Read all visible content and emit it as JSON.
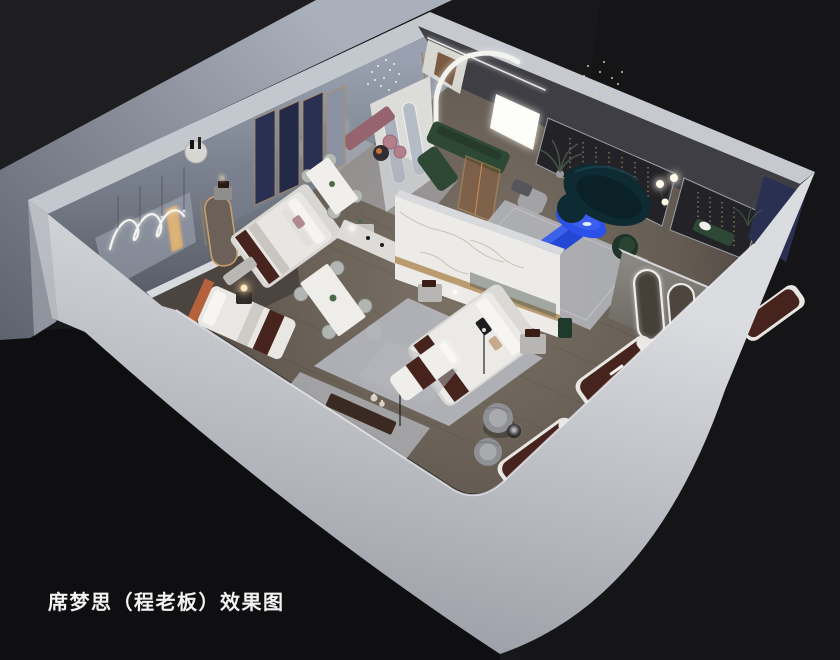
{
  "image": {
    "kind": "3d-isometric-interior-render",
    "subject": "mattress showroom cutaway floor-plan rendering",
    "caption": "席梦思（程老板）效果图"
  },
  "caption": {
    "text": "席梦思（程老板）效果图"
  },
  "palette": {
    "background": "#18181a",
    "background_deep": "#0f0f12",
    "outside_ground_light": "#a8adb8",
    "outside_ground_dark": "#5f6470",
    "wall_top": "#c5c9cf",
    "wall_inner_top": "#98a0af",
    "wall_inner_bottom": "#555a65",
    "floor_light": "#7d7367",
    "floor_dark": "#463f3a",
    "marble": "#edebe7",
    "gold": "#b08d5a",
    "accent_blue": "#2b51e8",
    "console_blue": "#2448d6",
    "sofa_teal": "#0e2b33",
    "sofa_green": "#2e4836",
    "armchair_green": "#1f3328",
    "mattress_brown": "#46231c",
    "headboard_terracotta": "#b5613c",
    "navy_panel": "#2a3052",
    "bench_mauve": "#96646e",
    "pouf_pink": "#b27f8a",
    "rug": "#b6b8bf",
    "neon_white": "#f4f4ef",
    "fairy_gold": "#d2b57f",
    "caption_text": "#f2f2f2"
  },
  "elements": [
    "neon-squiggle-wall-light",
    "pendant-crystal-cluster",
    "arched-led-portal",
    "pill-mirrors",
    "green-sectional-sofa",
    "mauve-bench",
    "pink-poufs",
    "curved-teal-sofa",
    "blue-coffee-table",
    "blue-media-console",
    "green-armchair",
    "fairy-light-display-wall",
    "navy-accent-panel",
    "marble-feature-wall",
    "double-bed-main",
    "double-bed-navy-room",
    "bed-terracotta-headboard",
    "dining-table-six-chairs",
    "dining-table-four-chairs",
    "white-display-console",
    "display-mattress",
    "arched-led-mirrors",
    "swivel-barrel-chairs",
    "round-side-table",
    "console-with-vases",
    "floor-lamp-spheres",
    "glowing-table-lamp",
    "rugs",
    "plants"
  ]
}
